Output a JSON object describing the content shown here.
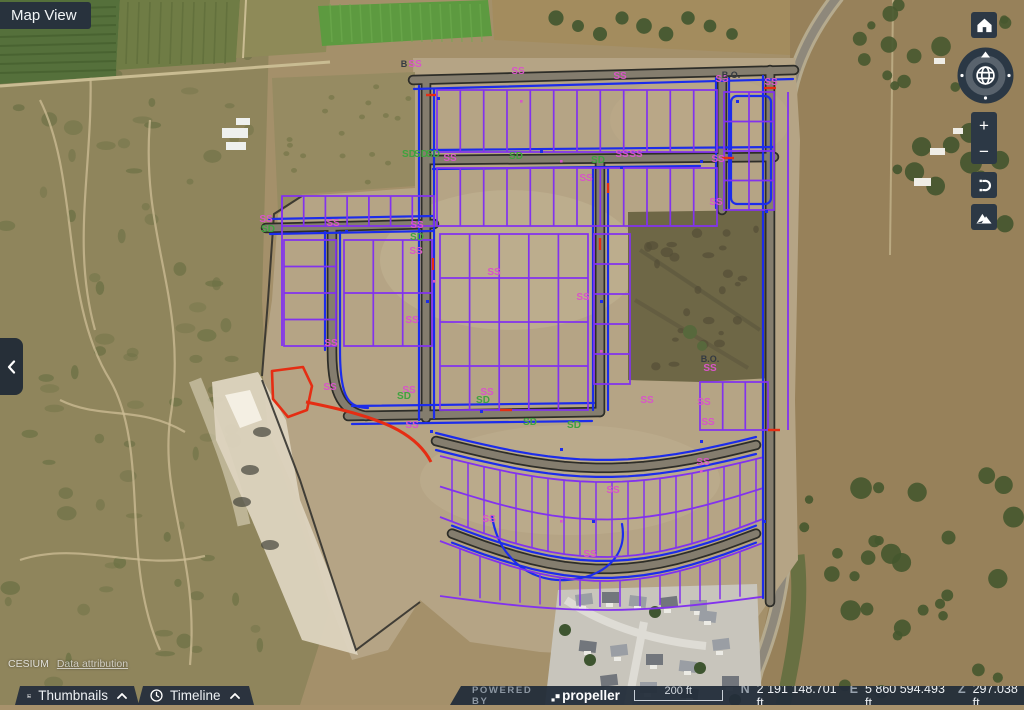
{
  "app": {
    "view_label": "Map View"
  },
  "left_panel_toggle": {
    "icon": "chevron-left-icon"
  },
  "nav_controls": {
    "home_icon": "home-icon",
    "compass_icon": "globe-compass-icon",
    "zoom_in_label": "+",
    "zoom_out_label": "−",
    "reset_orientation_icon": "reset-orientation-icon",
    "terrain_icon": "terrain-icon"
  },
  "bottom_tabs": [
    {
      "label": "Thumbnails",
      "icon": "image-icon"
    },
    {
      "label": "Timeline",
      "icon": "clock-icon"
    }
  ],
  "status_bar": {
    "powered_by_label": "POWERED BY",
    "brand": "propeller",
    "scale_label": "200 ft",
    "coordinates": [
      {
        "axis": "N",
        "value": "2 191 148.701 ft"
      },
      {
        "axis": "E",
        "value": "5 860 594.493 ft"
      },
      {
        "axis": "Z",
        "value": "297.038 ft"
      }
    ]
  },
  "attribution": {
    "source": "CESIUM",
    "link_label": "Data attribution"
  },
  "map": {
    "colors": {
      "lot_purple": "#8232ee",
      "utility_blue": "#1c2ceb",
      "alignment_red": "#e52d13",
      "label_ss": "#d855c8",
      "label_sd": "#3fa33f",
      "label_dark": "#343a42",
      "cad_road_dark": "#2f2f2b"
    },
    "labels": [
      {
        "t": "B",
        "x": 404,
        "y": 67,
        "k": "bo"
      },
      {
        "t": "SS",
        "x": 415,
        "y": 67,
        "k": "ss"
      },
      {
        "t": "SS",
        "x": 518,
        "y": 74,
        "k": "ss"
      },
      {
        "t": "SS",
        "x": 620,
        "y": 79,
        "k": "ss"
      },
      {
        "t": "SS",
        "x": 722,
        "y": 82,
        "k": "ss"
      },
      {
        "t": "B.O.",
        "x": 731,
        "y": 78,
        "k": "bo"
      },
      {
        "t": "SS",
        "x": 771,
        "y": 85,
        "k": "ss"
      },
      {
        "t": "SD",
        "x": 409,
        "y": 157,
        "k": "sd"
      },
      {
        "t": "SD",
        "x": 421,
        "y": 157,
        "k": "sd"
      },
      {
        "t": "SD",
        "x": 433,
        "y": 157,
        "k": "sd"
      },
      {
        "t": "SS",
        "x": 450,
        "y": 161,
        "k": "ss"
      },
      {
        "t": "SD",
        "x": 516,
        "y": 159,
        "k": "sd"
      },
      {
        "t": "SD",
        "x": 598,
        "y": 163,
        "k": "sd"
      },
      {
        "t": "SS",
        "x": 622,
        "y": 157,
        "k": "ss"
      },
      {
        "t": "SS",
        "x": 636,
        "y": 157,
        "k": "ss"
      },
      {
        "t": "SS",
        "x": 718,
        "y": 162,
        "k": "ss"
      },
      {
        "t": "SS",
        "x": 586,
        "y": 181,
        "k": "ss"
      },
      {
        "t": "SS",
        "x": 716,
        "y": 205,
        "k": "ss"
      },
      {
        "t": "SS",
        "x": 266,
        "y": 222,
        "k": "ss"
      },
      {
        "t": "SD",
        "x": 268,
        "y": 232,
        "k": "sd"
      },
      {
        "t": "SS",
        "x": 333,
        "y": 226,
        "k": "ss"
      },
      {
        "t": "SS",
        "x": 417,
        "y": 228,
        "k": "ss"
      },
      {
        "t": "SD",
        "x": 417,
        "y": 240,
        "k": "sd"
      },
      {
        "t": "SS",
        "x": 416,
        "y": 254,
        "k": "ss"
      },
      {
        "t": "SS",
        "x": 494,
        "y": 275,
        "k": "ss"
      },
      {
        "t": "SS",
        "x": 583,
        "y": 300,
        "k": "ss"
      },
      {
        "t": "SS",
        "x": 412,
        "y": 323,
        "k": "ss"
      },
      {
        "t": "SS",
        "x": 331,
        "y": 346,
        "k": "ss"
      },
      {
        "t": "B.O.",
        "x": 710,
        "y": 362,
        "k": "bo"
      },
      {
        "t": "SS",
        "x": 710,
        "y": 371,
        "k": "ss"
      },
      {
        "t": "SS",
        "x": 330,
        "y": 390,
        "k": "ss"
      },
      {
        "t": "SS",
        "x": 409,
        "y": 393,
        "k": "ss"
      },
      {
        "t": "SD",
        "x": 404,
        "y": 399,
        "k": "sd"
      },
      {
        "t": "SS",
        "x": 487,
        "y": 395,
        "k": "ss"
      },
      {
        "t": "SD",
        "x": 483,
        "y": 403,
        "k": "sd"
      },
      {
        "t": "SS",
        "x": 412,
        "y": 428,
        "k": "ss"
      },
      {
        "t": "SD",
        "x": 530,
        "y": 425,
        "k": "sd"
      },
      {
        "t": "SD",
        "x": 574,
        "y": 428,
        "k": "sd"
      },
      {
        "t": "SS",
        "x": 647,
        "y": 403,
        "k": "ss"
      },
      {
        "t": "SS",
        "x": 704,
        "y": 405,
        "k": "ss"
      },
      {
        "t": "SS",
        "x": 708,
        "y": 425,
        "k": "ss"
      },
      {
        "t": "SS",
        "x": 703,
        "y": 465,
        "k": "ss"
      },
      {
        "t": "SS",
        "x": 613,
        "y": 493,
        "k": "ss"
      },
      {
        "t": "SS",
        "x": 489,
        "y": 522,
        "k": "ss"
      },
      {
        "t": "SS",
        "x": 590,
        "y": 557,
        "k": "ss"
      }
    ]
  }
}
